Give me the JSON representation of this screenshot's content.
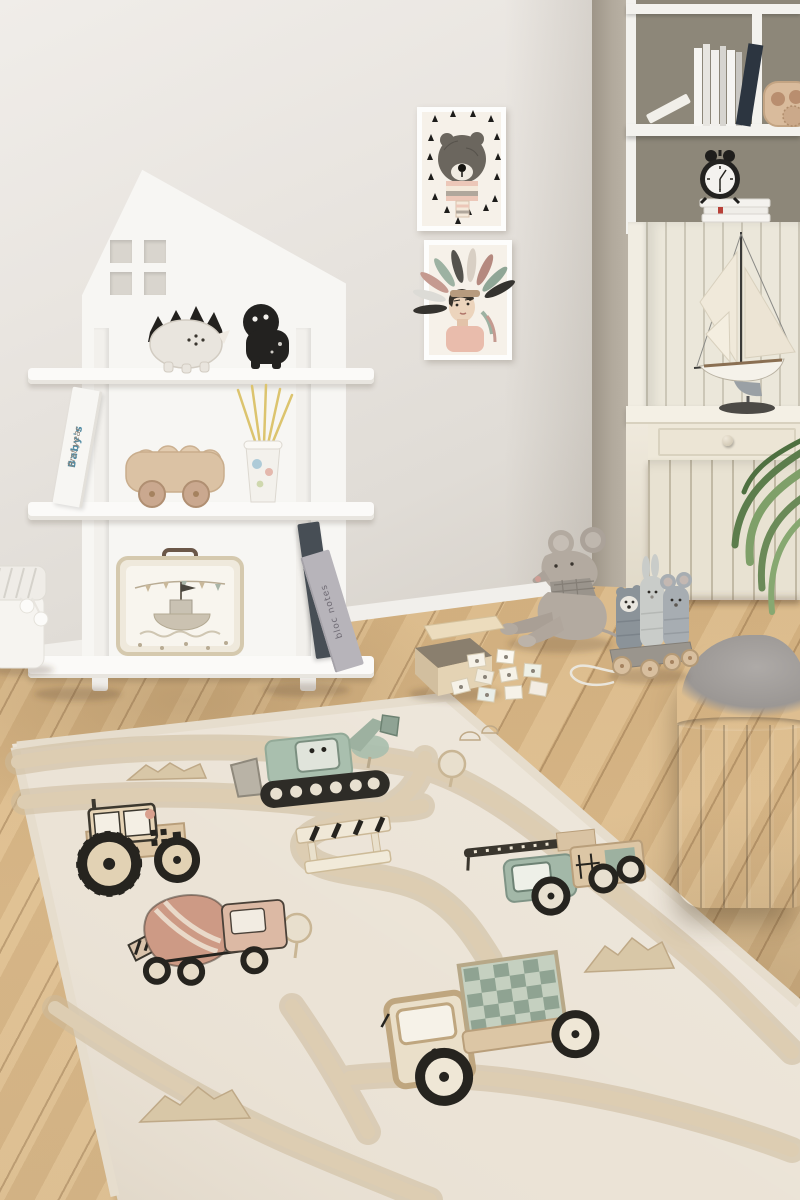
{
  "meta": {
    "type": "photograph",
    "description": "Scandinavian kids playroom: white house-shaped shelf with toys, two framed animal prints, cream cabinet with model sailboat, wooden floor, grey pouf, and a cream kids play rug with roads and construction vehicles"
  },
  "texts": {
    "baby_book_line1": "Baby's",
    "baby_book_line2": "first year",
    "notebook_spine": "bloc notes"
  },
  "palette": {
    "wall": "#e9e5e0",
    "wall_shadow": "#a89f92",
    "furniture_white": "#f7f6f3",
    "cabinet_cream": "#ebe7da",
    "floor_wood": "#d3ad7c",
    "rug_base": "#ebe3d6",
    "rug_road": "#d7c7ab",
    "rug_sage_green": "#a9bfae",
    "rug_pink": "#cd9a85",
    "rug_beige": "#dcc6a5",
    "rug_outline_dark": "#2e2c27",
    "pouf_grey": "#8c8885",
    "plush_grey": "#b3aaa0",
    "toy_wood": "#d9bb9c",
    "plant_green": "#6b8a58",
    "straw_yellow": "#dcc46e",
    "book_navy": "#2c3540"
  },
  "objects": [
    {
      "name": "house-shelf",
      "label": "white house-shaped shelf"
    },
    {
      "name": "dinosaur-toy",
      "label": "stegosaurus figurine"
    },
    {
      "name": "hippo-toy",
      "label": "black hippo figurine"
    },
    {
      "name": "baby-book",
      "label": "book: Baby's first year"
    },
    {
      "name": "wooden-car-toy",
      "label": "wooden peg-people bus"
    },
    {
      "name": "straw-cup",
      "label": "paper cup with yellow straws"
    },
    {
      "name": "toy-suitcase",
      "label": "suitcase with ship illustration"
    },
    {
      "name": "notebooks",
      "label": "leaning notebooks: bloc notes"
    },
    {
      "name": "fabric-basket",
      "label": "white fabric basket with pompoms"
    },
    {
      "name": "bear-print",
      "label": "framed bear with scarf print"
    },
    {
      "name": "headdress-print",
      "label": "framed child in feather headdress print"
    },
    {
      "name": "bookcase",
      "label": "white bookcase with books, wooden toy, alarm clock"
    },
    {
      "name": "sailboat-model",
      "label": "model sailboat on cabinet"
    },
    {
      "name": "cabinet",
      "label": "cream beadboard cabinet with drawer"
    },
    {
      "name": "plant",
      "label": "green plant leaves"
    },
    {
      "name": "mouse-plush",
      "label": "grey mouse plush"
    },
    {
      "name": "memory-game-box",
      "label": "wooden box with scattered memory cards"
    },
    {
      "name": "pull-toy",
      "label": "wooden pull toy with three animals"
    },
    {
      "name": "pouf",
      "label": "grey channel-tufted pouf"
    },
    {
      "name": "play-rug",
      "label": "cream kids road rug with construction vehicles"
    },
    {
      "name": "rug-excavator",
      "label": "green excavator"
    },
    {
      "name": "rug-tractor",
      "label": "beige tractor"
    },
    {
      "name": "rug-cement-mixer",
      "label": "pink cement mixer truck"
    },
    {
      "name": "rug-crane-truck",
      "label": "green crane truck with ladder"
    },
    {
      "name": "rug-cargo-truck",
      "label": "truck with green crates"
    },
    {
      "name": "rug-roads",
      "label": "tan roads"
    },
    {
      "name": "rug-mountains",
      "label": "mountain motifs"
    },
    {
      "name": "rug-trees",
      "label": "tree motifs"
    },
    {
      "name": "rug-barrier",
      "label": "construction barrier"
    }
  ]
}
